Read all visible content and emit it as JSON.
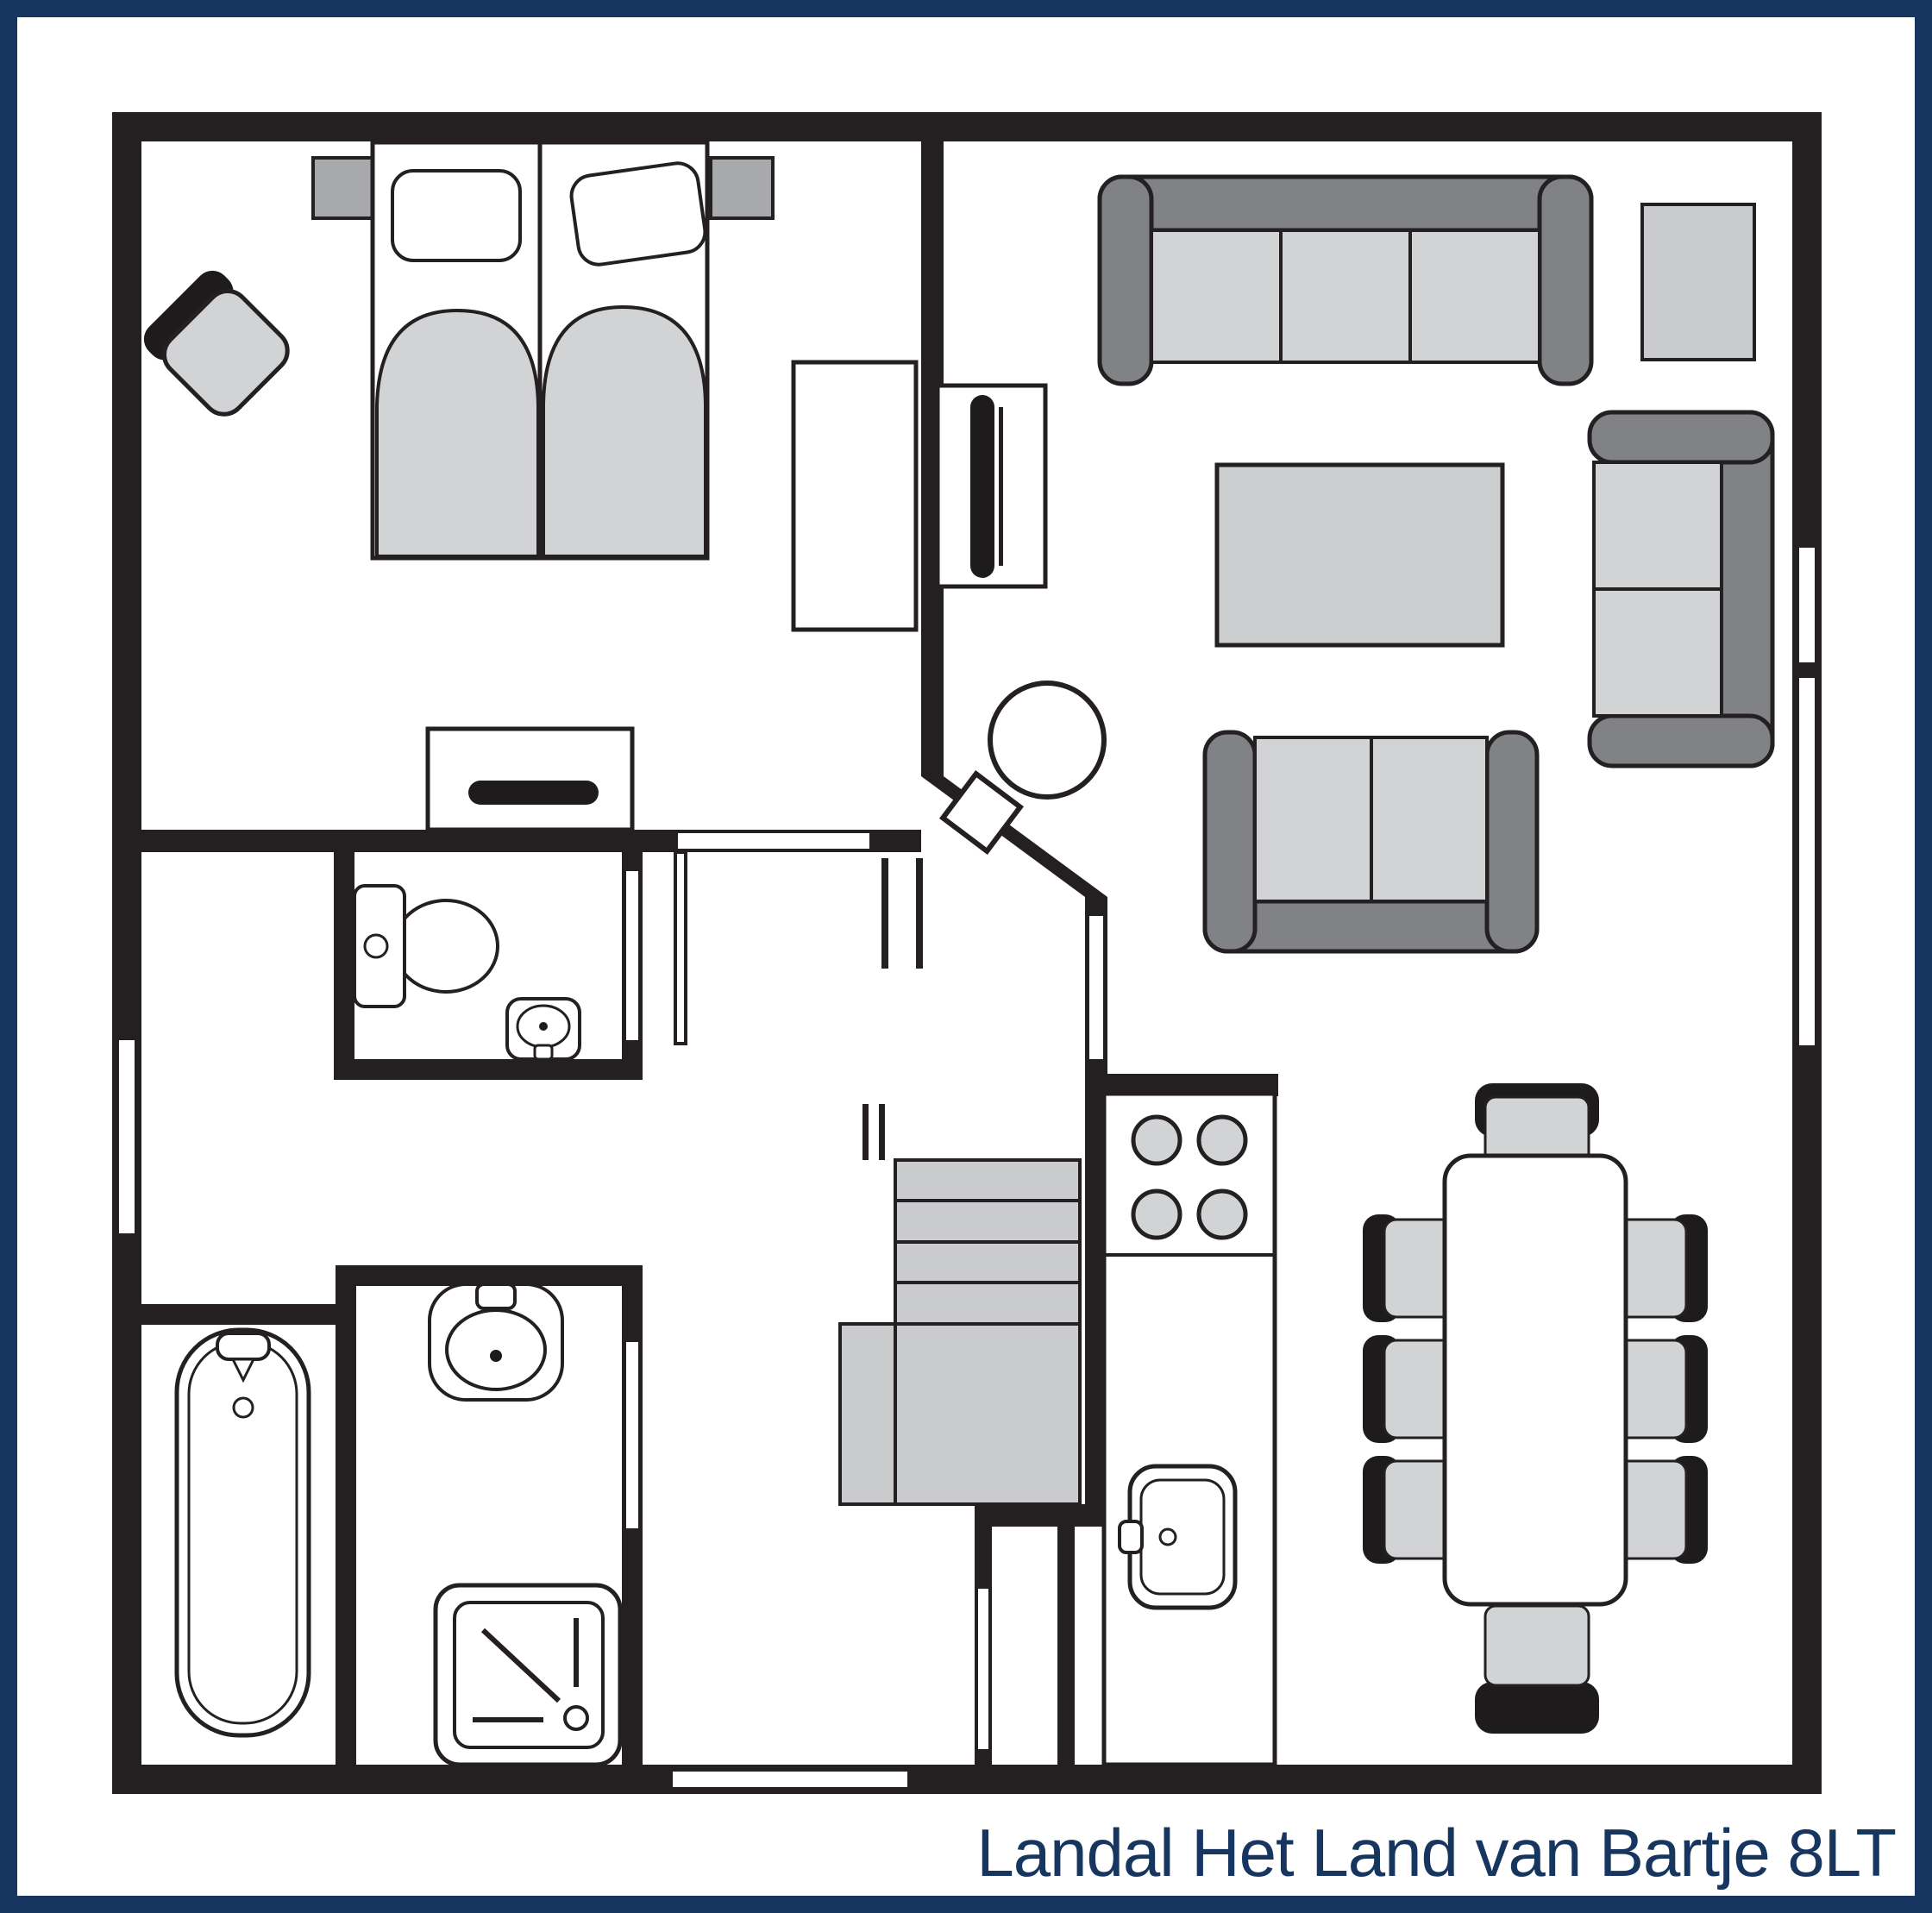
{
  "caption": "Landal Het Land van Bartje 8LT",
  "colors": {
    "frame": "#17365f",
    "wall": "#241f21",
    "floor": "#ffffff",
    "furniture_light": "#d2d3d5",
    "furniture_mid": "#a7a9ac",
    "furniture_dark": "#808285",
    "stairs": "#c9cbcd",
    "table_gray": "#ccced0",
    "chair_black": "#1d1b1c"
  },
  "fixture_icons": [
    "double-bed-icon",
    "pillow-icon",
    "duvet-icon",
    "nightstand-icon",
    "chair-icon",
    "wardrobe-icon",
    "dresser-icon",
    "tv-cabinet-icon",
    "tv-icon",
    "sofa-3seat-icon",
    "sofa-2seat-icon",
    "side-table-icon",
    "coffee-table-icon",
    "wood-stove-icon",
    "toilet-icon",
    "hand-basin-icon",
    "washbasin-icon",
    "bathtub-icon",
    "shower-icon",
    "stairs-icon",
    "kitchen-counter-icon",
    "hob-burners-icon",
    "kitchen-sink-icon",
    "dining-table-icon",
    "dining-chair-icon",
    "window-icon",
    "door-icon"
  ]
}
